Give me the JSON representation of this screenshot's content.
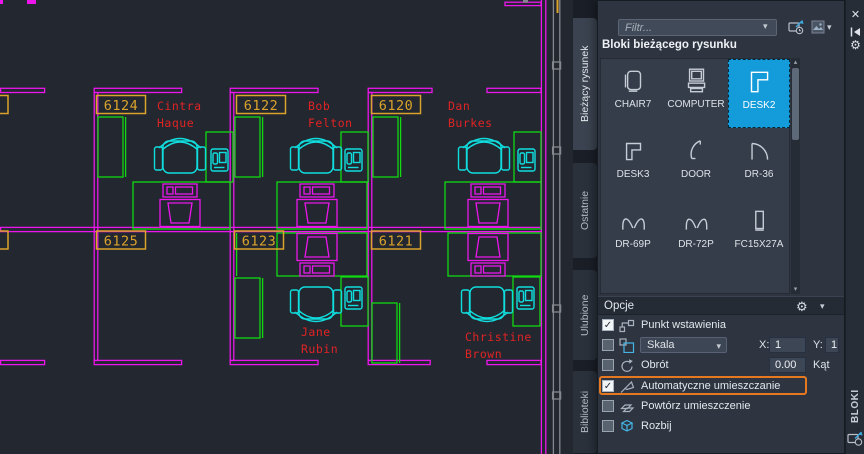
{
  "icons": {
    "chevron_down": "▾",
    "scroll_up": "▴",
    "scroll_down": "▾",
    "close": "✕",
    "gear": "⚙",
    "check": "✓"
  },
  "drawing": {
    "rooms": [
      {
        "number": "6124",
        "occupant": [
          "Cintra",
          "Haque"
        ]
      },
      {
        "number": "6122",
        "occupant": [
          "Bob",
          "Felton"
        ]
      },
      {
        "number": "6120",
        "occupant": [
          "Dan",
          "Burkes"
        ]
      },
      {
        "number": "6125",
        "occupant": []
      },
      {
        "number": "6123",
        "occupant": [
          "Jane",
          "Rubin"
        ]
      },
      {
        "number": "6121",
        "occupant": [
          "Christine",
          "Brown"
        ]
      }
    ]
  },
  "palette": {
    "filter_placeholder": "Filtr...",
    "blocks_header": "Bloki bieżącego rysunku",
    "tabs": [
      {
        "label": "Bieżący rysunek"
      },
      {
        "label": "Ostatnie"
      },
      {
        "label": "Ulubione"
      },
      {
        "label": "Biblioteki"
      }
    ],
    "blocks": [
      {
        "label": "CHAIR7"
      },
      {
        "label": "COMPUTER"
      },
      {
        "label": "DESK2"
      },
      {
        "label": "DESK3"
      },
      {
        "label": "DOOR"
      },
      {
        "label": "DR-36"
      },
      {
        "label": "DR-69P"
      },
      {
        "label": "DR-72P"
      },
      {
        "label": "FC15X27A"
      }
    ],
    "options": {
      "title": "Opcje",
      "rows": [
        {
          "label": "Punkt wstawienia"
        },
        {
          "label": "Skala"
        },
        {
          "label": "Obrót"
        },
        {
          "label": "Automatyczne umieszczanie"
        },
        {
          "label": "Powtórz umieszczenie"
        },
        {
          "label": "Rozbij"
        }
      ],
      "scale_x_label": "X:",
      "scale_x_value": "1",
      "scale_y_label": "Y:",
      "scale_y_value": "1",
      "angle_value": "0.00",
      "angle_label": "Kąt"
    },
    "side_title": "BLOKI"
  }
}
